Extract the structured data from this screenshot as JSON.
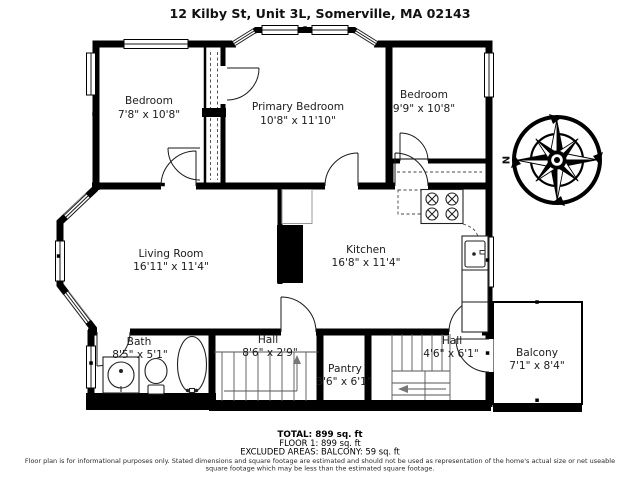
{
  "title": "12 Kilby St, Unit 3L, Somerville, MA 02143",
  "compass": {
    "label": "N"
  },
  "rooms": {
    "bedroom_left": {
      "name": "Bedroom",
      "dims": "7'8\" x 10'8\""
    },
    "primary_bedroom": {
      "name": "Primary Bedroom",
      "dims": "10'8\" x 11'10\""
    },
    "bedroom_right": {
      "name": "Bedroom",
      "dims": "9'9\" x 10'8\""
    },
    "living_room": {
      "name": "Living Room",
      "dims": "16'11\" x 11'4\""
    },
    "kitchen": {
      "name": "Kitchen",
      "dims": "16'8\" x 11'4\""
    },
    "bath": {
      "name": "Bath",
      "dims": "8'5\" x 5'1\""
    },
    "hall_1": {
      "name": "Hall",
      "dims": "8'6\" x 2'9\""
    },
    "pantry": {
      "name": "Pantry",
      "dims": "3'6\" x 6'1\""
    },
    "hall_2": {
      "name": "Hall",
      "dims": "4'6\" x 6'1\""
    },
    "balcony": {
      "name": "Balcony",
      "dims": "7'1\" x 8'4\""
    }
  },
  "summary": {
    "total": "TOTAL: 899 sq. ft",
    "floor1": "FLOOR 1: 899 sq. ft",
    "excluded": "EXCLUDED AREAS: BALCONY: 59 sq. ft"
  },
  "disclaimer": [
    "Floor plan is for informational purposes only. Stated dimensions and square footage are estimated and should not be used as representation of the home's actual size or net useable",
    "square footage which may be less than the estimated square footage."
  ],
  "colors": {
    "walls": "#000000",
    "background": "#ffffff",
    "text": "#1c1c1c"
  }
}
